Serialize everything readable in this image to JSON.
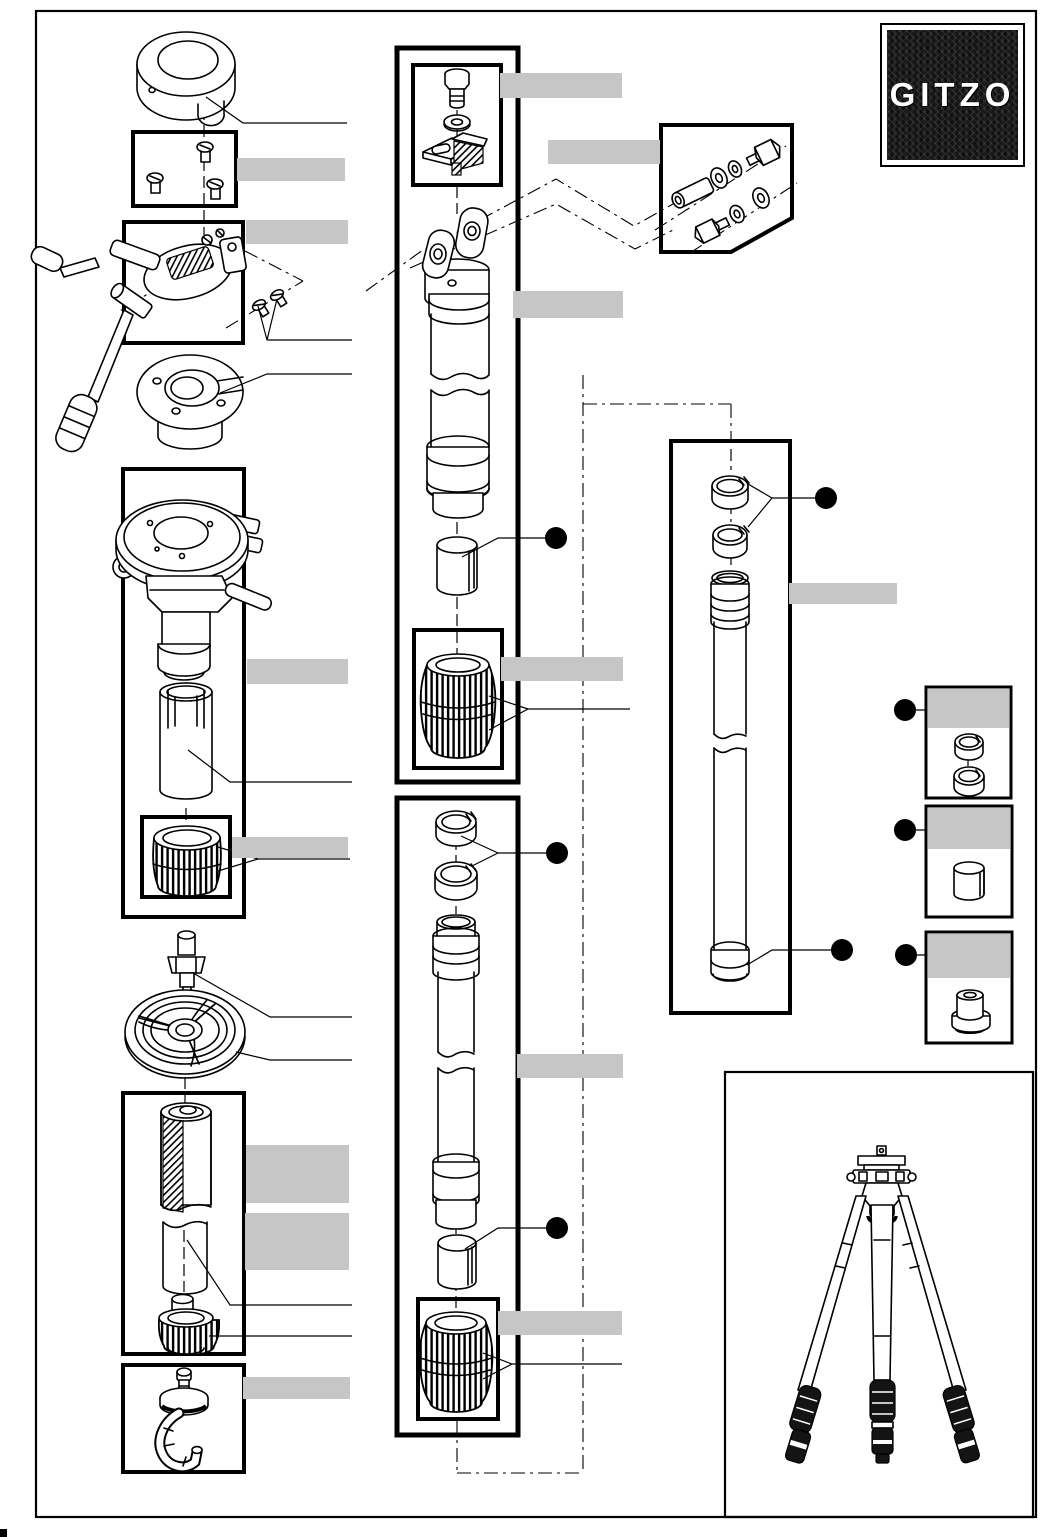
{
  "page": {
    "background": "#ffffff",
    "border_color": "#000000",
    "kind": "exploded-parts-diagram"
  },
  "brand": {
    "logo_text": "GITZO",
    "logo_bg": "#161616",
    "logo_text_color": "#ffffff"
  },
  "diagram": {
    "label_bar_color": "#c6c6c6",
    "callout_dot_color": "#000000",
    "redacted_label_count": 17,
    "callout_dot_count": 8,
    "panel_count": 12
  }
}
